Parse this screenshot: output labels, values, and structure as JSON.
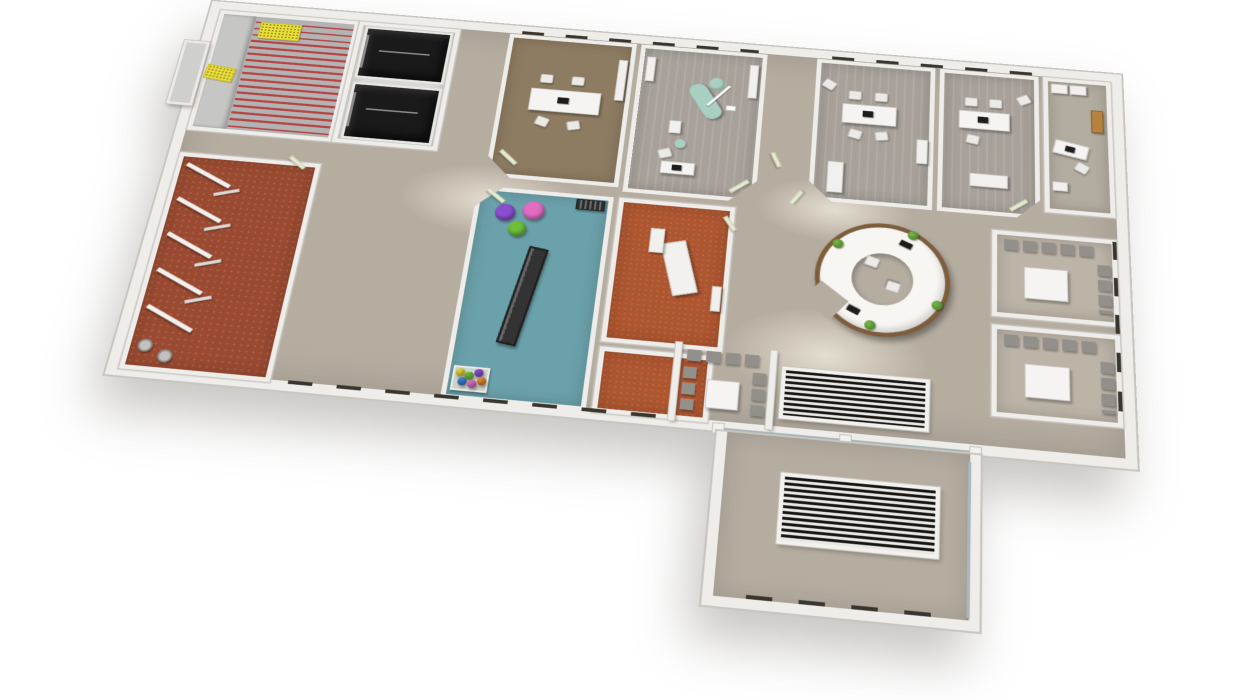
{
  "palette": {
    "background": "#ffffff",
    "outer_wall": "#efedea",
    "wall_edge": "#c8c5c0",
    "hall_floor": "#b5ada0",
    "corridor_floor": "#bdb5a8",
    "wood_floor": "#8d7c62",
    "treatment_floor": "#a7a19a",
    "office_ne_floor": "#b3aca0",
    "waiting_floor": "#bcb4a7",
    "wc_floor": "#9a4a31",
    "playroom_floor": "#6ba1ab",
    "xray_floor": "#ae5630",
    "stair_floor": "#b3b3b3",
    "stair_landing": "#c6c6c4",
    "stair_nosing_red": "#b64444",
    "tactile_pad_yellow": "#ebe13c",
    "elevator_shaft": "#1a1a1a",
    "reception_wood": "#7d5e3c",
    "reception_counter": "#f7f6f3",
    "dental_chair_mint": "#a9cfc2",
    "furniture_white": "#f5f4f2",
    "chair_gray": "#93908c",
    "plant_green": "#4e8a2b",
    "door_leaf": "#e7ebd2",
    "grating_dark": "#161616",
    "ball_purple": "#8a4fd0",
    "ball_pink": "#e06cc3",
    "ball_green": "#6fbe3a",
    "ballpit_yellow": "#e7d832",
    "ballpit_blue": "#3f7fd4",
    "ballpit_orange": "#e78a2e",
    "exam_table_white": "#f2f1ef",
    "mat_dark": "#333333",
    "glass": "#a8b6ba"
  }
}
